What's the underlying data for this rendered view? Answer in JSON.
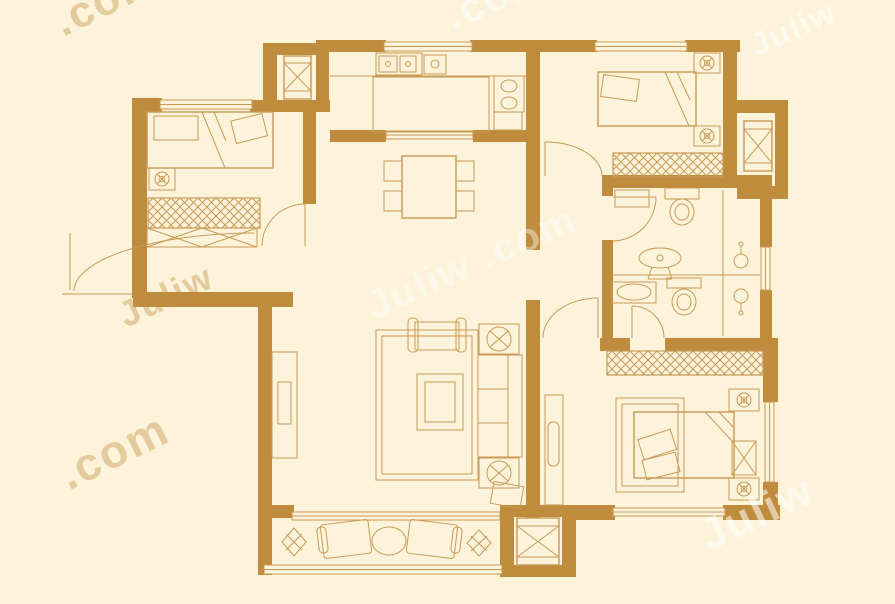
{
  "app": {
    "type": "apartment-floor-plan",
    "rooms_visible": 9
  },
  "colors": {
    "bg": "#fcf3da",
    "wall": "#bf8c3e",
    "line": "#c89a55",
    "wm_tan": "rgba(191,143,64,0.40)",
    "wm_white": "rgba(255,255,255,0.55)"
  },
  "watermarks": [
    {
      "text": ".com"
    },
    {
      "text": ".com"
    },
    {
      "text": "Juliw"
    },
    {
      "text": "Juliw"
    },
    {
      "text": ".com"
    },
    {
      "text": "Juliw"
    },
    {
      "text": "Juliw .com"
    }
  ]
}
